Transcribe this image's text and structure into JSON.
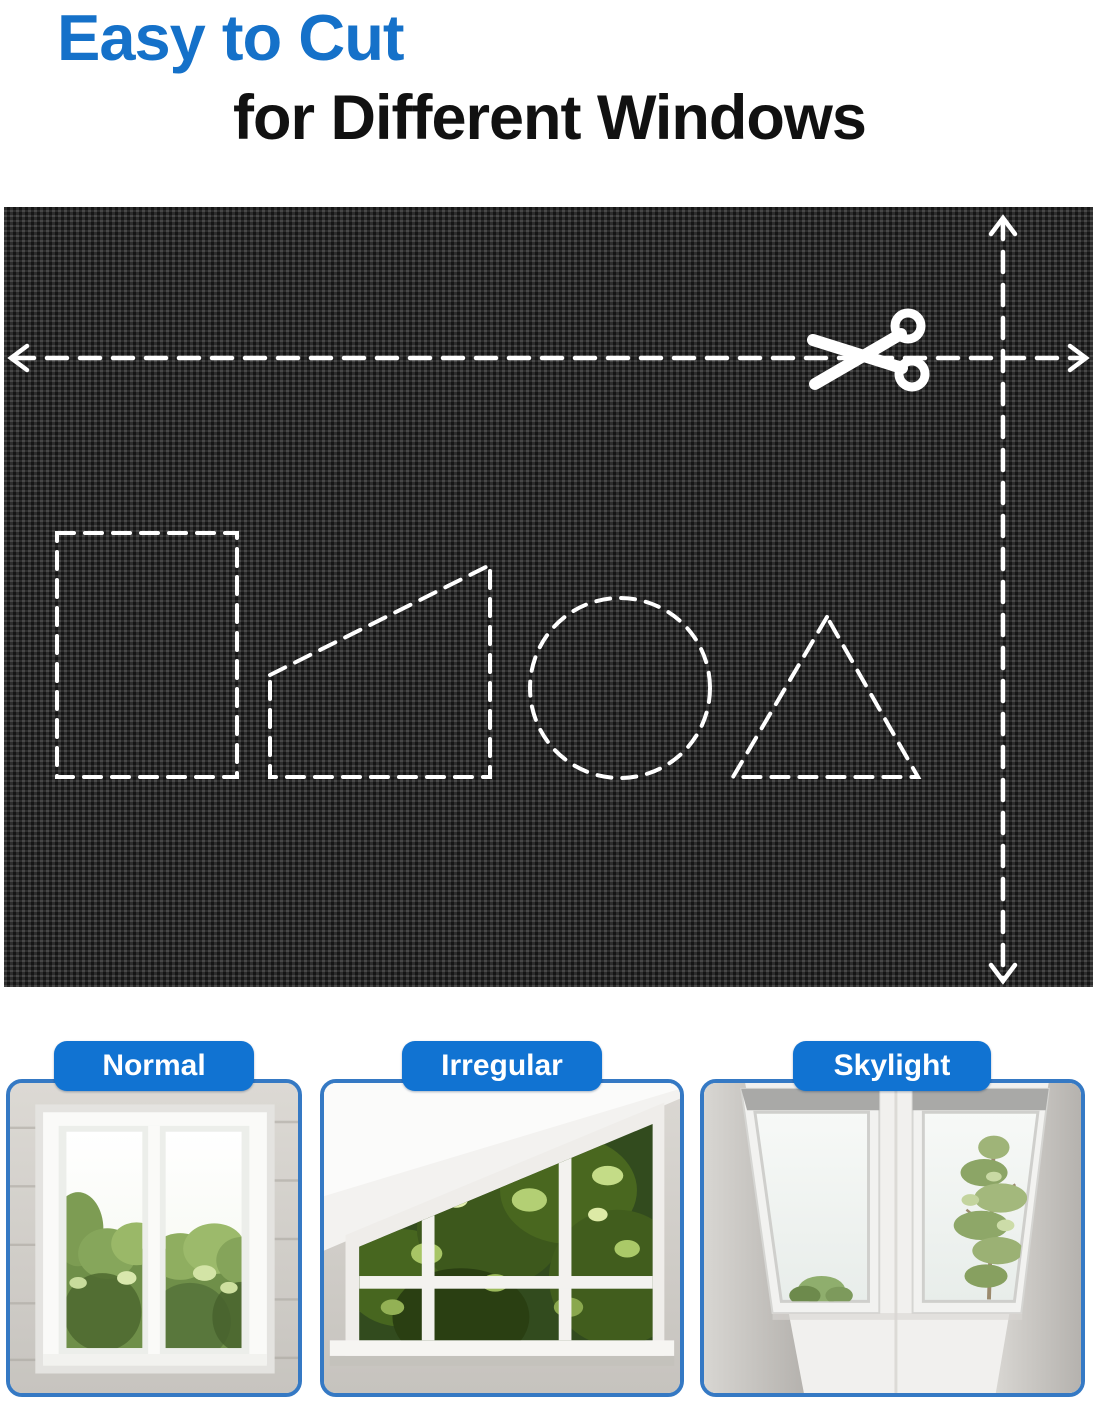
{
  "page": {
    "width": 1093,
    "height": 1407,
    "background": "#ffffff"
  },
  "header": {
    "title_line1": "Easy to Cut",
    "title_line2": "for Different Windows"
  },
  "fabric_panel": {
    "material": "black woven blackout fabric swatch",
    "icons": [
      "scissors-icon",
      "arrow-left-icon",
      "arrow-right-icon",
      "arrow-up-icon",
      "arrow-down-icon"
    ],
    "cut_guides": [
      "horizontal-dashed-cut-line",
      "vertical-dashed-cut-line"
    ],
    "shape_guides": [
      "rectangle",
      "right-trapezoid",
      "circle",
      "triangle"
    ]
  },
  "window_cards": [
    {
      "label": "Normal"
    },
    {
      "label": "Irregular"
    },
    {
      "label": "Skylight"
    }
  ],
  "colors": {
    "title_blue": "#1571c9",
    "title_black": "#111111",
    "badge_blue": "#1173d2",
    "badge_text": "#ffffff",
    "card_border_blue": "#3579c4",
    "fabric_black": "#1e1e1e",
    "guide_white": "#ffffff"
  }
}
